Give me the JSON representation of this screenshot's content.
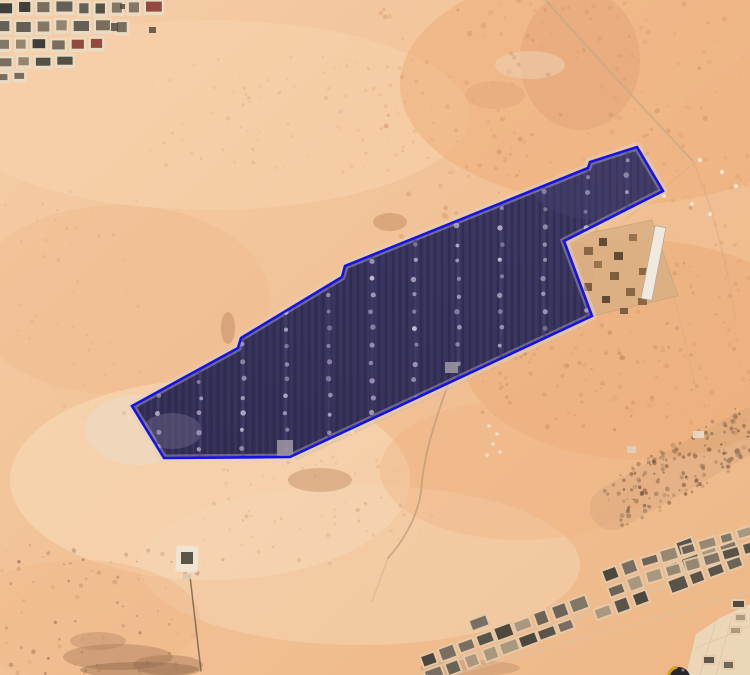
{
  "meta": {
    "width": 750,
    "height": 675,
    "view": "satellite-aerial-desert-solar-farm"
  },
  "colors": {
    "sand_tl": "#f5cda6",
    "sand_mid": "#f1c094",
    "sand_br": "#eeb787",
    "boundary_blue": "#1412e9",
    "boundary_halo": "#e3d2ba",
    "farm_top": "#3d3864",
    "farm_bottom": "#322e54",
    "farm_stripe_dark": "#2b2749",
    "farm_stripe_light": "#443e6c",
    "farm_lane": "#4a4474",
    "farm_dot": "#a9a1bc",
    "farm_dot_bright": "#c7c0d6",
    "farm_inner_margin": "#b5aebd",
    "farm_inner_building": "#9a94a2",
    "wall_light": "#e8dcc6",
    "road_tan": "#c8a987",
    "track_light": "#dcc3a2",
    "wall_dark_line": "#6f5c49",
    "compass_body": "#26262c",
    "compass_gold": "#d2a01e"
  },
  "solar_farm": {
    "boundary_points": "132,406 238,348 241,338 342,277 345,266 588,168 590,162 637,147 663,191 564,241 592,316 290,457 164,458",
    "lane_xs": [
      158,
      200,
      243,
      286,
      329,
      372,
      415,
      458,
      501,
      544,
      587,
      627
    ],
    "dot_y_start": 142,
    "dot_y_end": 468,
    "dot_spacing": 17,
    "inner_buildings": [
      {
        "x": 277,
        "y": 440,
        "w": 16,
        "h": 18
      },
      {
        "x": 445,
        "y": 362,
        "w": 13,
        "h": 11
      }
    ],
    "tip_highlight": {
      "cx": 172,
      "cy": 431,
      "rx": 30,
      "ry": 18,
      "fill": "#8b85a0",
      "op": 0.32
    },
    "tr_highlight": {
      "cx": 600,
      "cy": 182,
      "rx": 70,
      "ry": 38,
      "fill": "#4a4570",
      "op": 0.35
    }
  },
  "terrain": {
    "washes": [
      {
        "cx": 210,
        "cy": 115,
        "rx": 260,
        "ry": 95,
        "fill": "#f7d3ae",
        "op": 0.5
      },
      {
        "cx": 120,
        "cy": 300,
        "rx": 150,
        "ry": 95,
        "fill": "#efba8d",
        "op": 0.45
      },
      {
        "cx": 210,
        "cy": 480,
        "rx": 200,
        "ry": 100,
        "fill": "#f8dcbc",
        "op": 0.55
      },
      {
        "cx": 360,
        "cy": 565,
        "rx": 220,
        "ry": 80,
        "fill": "#f6d6b4",
        "op": 0.5
      },
      {
        "cx": 620,
        "cy": 85,
        "rx": 220,
        "ry": 120,
        "fill": "#eda874",
        "op": 0.45
      },
      {
        "cx": 580,
        "cy": 60,
        "rx": 60,
        "ry": 70,
        "fill": "#dd9c70",
        "op": 0.35
      },
      {
        "cx": 640,
        "cy": 350,
        "rx": 180,
        "ry": 110,
        "fill": "#eba770",
        "op": 0.45
      },
      {
        "cx": 520,
        "cy": 470,
        "rx": 140,
        "ry": 70,
        "fill": "#f0b585",
        "op": 0.4
      },
      {
        "cx": 80,
        "cy": 620,
        "rx": 120,
        "ry": 60,
        "fill": "#efb98a",
        "op": 0.45
      },
      {
        "cx": 140,
        "cy": 430,
        "rx": 55,
        "ry": 35,
        "fill": "#ecd9c3",
        "op": 0.65
      },
      {
        "cx": 530,
        "cy": 65,
        "rx": 35,
        "ry": 14,
        "fill": "#eed3b6",
        "op": 0.5
      },
      {
        "cx": 495,
        "cy": 95,
        "rx": 30,
        "ry": 14,
        "fill": "#dfa071",
        "op": 0.3
      },
      {
        "cx": 390,
        "cy": 222,
        "rx": 17,
        "ry": 9,
        "fill": "#c68f66",
        "op": 0.55
      },
      {
        "cx": 320,
        "cy": 480,
        "rx": 32,
        "ry": 12,
        "fill": "#c08a62",
        "op": 0.45
      },
      {
        "cx": 228,
        "cy": 328,
        "rx": 7,
        "ry": 16,
        "fill": "#c08a62",
        "op": 0.5
      },
      {
        "cx": 580,
        "cy": 272,
        "rx": 14,
        "ry": 30,
        "fill": "#c08a5e",
        "op": 0.45
      }
    ],
    "speckle_regions": [
      {
        "x": 380,
        "y": 0,
        "w": 370,
        "h": 245,
        "n": 230,
        "colors": [
          "#e2a273",
          "#d79a6b",
          "#cf8f63"
        ],
        "rmin": 0.8,
        "rmax": 2.8,
        "omin": 0.2,
        "omax": 0.55
      },
      {
        "x": 470,
        "y": 260,
        "w": 280,
        "h": 170,
        "n": 190,
        "colors": [
          "#dd9a6e",
          "#d08f63",
          "#c8855c"
        ],
        "rmin": 0.8,
        "rmax": 2.6,
        "omin": 0.2,
        "omax": 0.55
      },
      {
        "x": 140,
        "y": 55,
        "w": 280,
        "h": 120,
        "n": 85,
        "colors": [
          "#e6ad80",
          "#daa077"
        ],
        "rmin": 0.7,
        "rmax": 2.2,
        "omin": 0.15,
        "omax": 0.4
      },
      {
        "x": 200,
        "y": 455,
        "w": 240,
        "h": 110,
        "n": 70,
        "colors": [
          "#dda47a",
          "#c89066"
        ],
        "rmin": 0.7,
        "rmax": 2.2,
        "omin": 0.15,
        "omax": 0.45
      },
      {
        "x": 0,
        "y": 545,
        "w": 200,
        "h": 130,
        "n": 85,
        "colors": [
          "#d49a6f",
          "#86604a",
          "#a87e5c"
        ],
        "rmin": 0.7,
        "rmax": 2.4,
        "omin": 0.2,
        "omax": 0.6
      },
      {
        "x": 0,
        "y": 190,
        "w": 140,
        "h": 230,
        "n": 55,
        "colors": [
          "#e3aa7d",
          "#d89d72"
        ],
        "rmin": 0.7,
        "rmax": 2.0,
        "omin": 0.15,
        "omax": 0.38
      }
    ],
    "dark_blobs": [
      {
        "cx": 118,
        "cy": 657,
        "rx": 55,
        "ry": 13,
        "fill": "#a97c5c",
        "op": 0.45
      },
      {
        "cx": 168,
        "cy": 665,
        "rx": 35,
        "ry": 10,
        "fill": "#9a6f50",
        "op": 0.4
      },
      {
        "cx": 98,
        "cy": 641,
        "rx": 28,
        "ry": 9,
        "fill": "#a97c5c",
        "op": 0.35
      },
      {
        "cx": 140,
        "cy": 670,
        "rx": 60,
        "ry": 8,
        "fill": "#7d583f",
        "op": 0.35
      },
      {
        "cx": 470,
        "cy": 668,
        "rx": 50,
        "ry": 8,
        "fill": "#a97c5c",
        "op": 0.3
      }
    ]
  },
  "roads": [
    {
      "d": "M 543,-3 C 570,28 640,105 692,160",
      "color": "#c8a987",
      "w": 2,
      "op": 0.75
    },
    {
      "d": "M 692,160 C 708,195 724,245 736,322",
      "color": "#c8a987",
      "w": 1.6,
      "op": 0.35
    },
    {
      "d": "M 694,163 L 625,220",
      "color": "#c8a987",
      "w": 1.4,
      "op": 0.3
    },
    {
      "d": "M 448,384 C 436,420 424,450 421,492 C 417,520 400,545 388,558",
      "color": "#b99a78",
      "w": 1.8,
      "op": 0.7
    },
    {
      "d": "M 388,558 L 372,602",
      "color": "#b99a78",
      "w": 1.5,
      "op": 0.3
    },
    {
      "d": "M 594,320 L 296,459",
      "color": "#d6bb9b",
      "w": 3,
      "op": 0.5
    },
    {
      "d": "M 136,402 L 634,144",
      "color": "#e8d2b4",
      "w": 5,
      "op": 0.32
    },
    {
      "d": "M 420,673 L 750,556",
      "color": "#dcc3a2",
      "w": 2.5,
      "op": 0.7
    },
    {
      "d": "M 452,675 L 750,592",
      "color": "#dcc3a2",
      "w": 2,
      "op": 0.5
    },
    {
      "d": "M 660,248 C 672,290 684,330 696,392",
      "color": "#c8a987",
      "w": 1.4,
      "op": 0.32
    },
    {
      "d": "M 190,576 L 201,671",
      "color": "#6f5c49",
      "w": 1.5,
      "op": 0.8
    }
  ],
  "settlements": {
    "top_left": {
      "rows": [
        {
          "y": 0,
          "h": 16,
          "x_end": 160
        },
        {
          "y": 19,
          "h": 16,
          "x_end": 128
        },
        {
          "y": 37,
          "h": 15,
          "x_end": 96
        },
        {
          "y": 55,
          "h": 14,
          "x_end": 60
        },
        {
          "y": 71,
          "h": 12,
          "x_end": 26
        }
      ],
      "wall": "#e8dcc6",
      "roofs": [
        "#43403a",
        "#6e6152",
        "#8c7b66",
        "#55514b",
        "#7a6c5c",
        "#2f2d2a",
        "#8a3a30"
      ],
      "specks": [
        {
          "x": 111,
          "y": 23,
          "w": 7,
          "h": 8
        },
        {
          "x": 149,
          "y": 27,
          "w": 7,
          "h": 6
        },
        {
          "x": 120,
          "y": 4,
          "w": 5,
          "h": 5
        }
      ]
    },
    "bottom_right_band": {
      "p0": [
        432,
        668
      ],
      "p1": [
        748,
        551
      ],
      "offsets": [
        -9,
        7
      ],
      "scatter_offset": -26,
      "step": 20,
      "cw": 18,
      "ch": 14,
      "wall": "#e4cba8",
      "roofs": [
        "#5b554d",
        "#746a5c",
        "#8d7e6a",
        "#46423c",
        "#a29179",
        "#38352f",
        "#6a6158"
      ]
    },
    "upper_right_corner": {
      "p0": [
        652,
        568
      ],
      "p1": [
        748,
        540
      ],
      "offsets": [
        -8,
        8
      ],
      "step": 20,
      "cw": 17,
      "ch": 13,
      "wall": "#e4cba8",
      "roofs": [
        "#5b554d",
        "#746a5c",
        "#8d7e6a",
        "#46423c",
        "#a29179"
      ]
    },
    "right_edge_strip": [
      {
        "x": 731,
        "y": 599,
        "w": 15,
        "h": 10
      },
      {
        "x": 734,
        "y": 613,
        "w": 13,
        "h": 9
      },
      {
        "x": 729,
        "y": 626,
        "w": 13,
        "h": 9
      },
      {
        "x": 702,
        "y": 655,
        "w": 14,
        "h": 10
      },
      {
        "x": 722,
        "y": 660,
        "w": 13,
        "h": 10
      }
    ],
    "paved_area": {
      "points": "686,675 696,634 720,618 750,604 750,675",
      "fill": "#ead8bb",
      "lines": [
        "M 700,675 L 716,622",
        "M 716,675 L 732,616",
        "M 696,648 L 750,626"
      ]
    }
  },
  "substation": {
    "yard_points": "565,238 652,220 678,296 592,316",
    "yard_fill": "#d9af85",
    "long_building": {
      "x": 648,
      "y": 226,
      "w": 11,
      "h": 74,
      "rot": 11,
      "fill": "#efe9df",
      "stroke": "#b9a98f"
    },
    "units": [
      {
        "x": 584,
        "y": 247,
        "w": 9,
        "h": 8
      },
      {
        "x": 599,
        "y": 238,
        "w": 8,
        "h": 8
      },
      {
        "x": 614,
        "y": 252,
        "w": 9,
        "h": 8
      },
      {
        "x": 629,
        "y": 234,
        "w": 8,
        "h": 7
      },
      {
        "x": 610,
        "y": 272,
        "w": 9,
        "h": 8
      },
      {
        "x": 626,
        "y": 288,
        "w": 9,
        "h": 8
      },
      {
        "x": 639,
        "y": 268,
        "w": 8,
        "h": 7
      },
      {
        "x": 594,
        "y": 261,
        "w": 8,
        "h": 7
      },
      {
        "x": 584,
        "y": 283,
        "w": 8,
        "h": 8
      },
      {
        "x": 638,
        "y": 298,
        "w": 9,
        "h": 7
      },
      {
        "x": 602,
        "y": 296,
        "w": 8,
        "h": 7
      },
      {
        "x": 620,
        "y": 308,
        "w": 8,
        "h": 6
      }
    ],
    "unit_colors": [
      "#6a4f33",
      "#7a5a3a",
      "#4a3a28",
      "#8a6a44"
    ],
    "white_specks": [
      [
        700,
        160
      ],
      [
        722,
        172
      ],
      [
        736,
        186
      ],
      [
        692,
        204
      ],
      [
        710,
        214
      ],
      [
        664,
        196
      ]
    ]
  },
  "rocky_band": {
    "p0": [
      612,
      508
    ],
    "p1": [
      750,
      430
    ],
    "halfwidth": 26,
    "n": 170,
    "base_color": "#c49a74",
    "colors": [
      "#8a6a50",
      "#75543e",
      "#a08060"
    ],
    "buildings": [
      {
        "x": 693,
        "y": 431,
        "w": 11,
        "h": 7,
        "fill": "#e8dcc8"
      },
      {
        "x": 627,
        "y": 446,
        "w": 9,
        "h": 7,
        "fill": "#ddd0ba"
      }
    ]
  },
  "misc": {
    "small_compound": {
      "x": 176,
      "y": 546,
      "w": 22,
      "h": 26,
      "wall": "#efe6d6",
      "inner": {
        "x": 181,
        "y": 552,
        "w": 12,
        "h": 12,
        "fill": "#4a443a"
      },
      "annex": {
        "x": 183,
        "y": 574,
        "w": 8,
        "h": 5,
        "fill": "#d8c9b2"
      }
    },
    "debris_dots": [
      [
        489,
        426
      ],
      [
        497,
        434
      ],
      [
        493,
        444
      ],
      [
        500,
        452
      ],
      [
        487,
        455
      ],
      [
        352,
        432
      ]
    ]
  },
  "compass": {
    "cx": 679,
    "cy": 678,
    "r": 11
  }
}
